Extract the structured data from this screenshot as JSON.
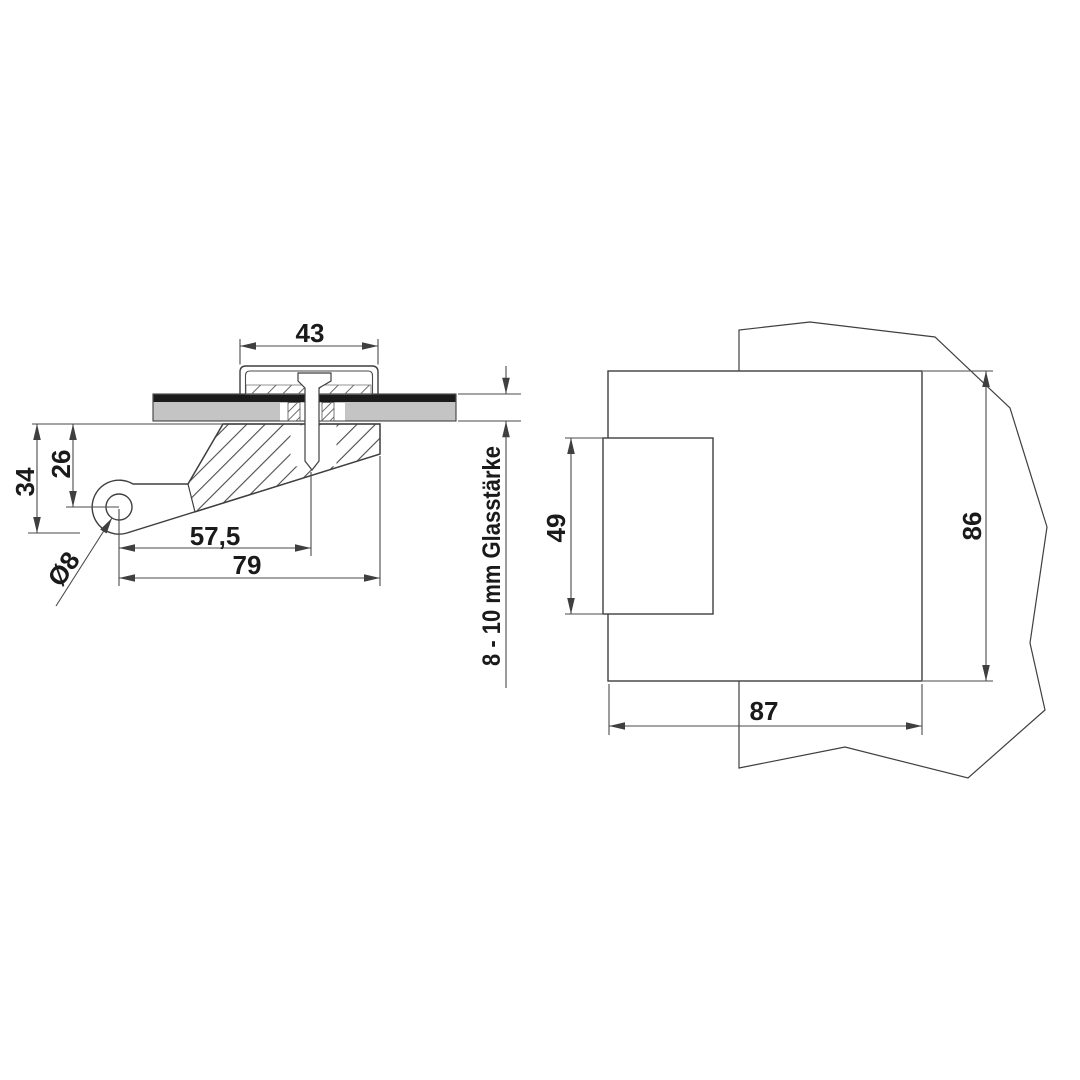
{
  "drawing": {
    "kind": "glass-clamp-fitting-technical-drawing",
    "views": {
      "side": {
        "dims": {
          "cap_width": "43",
          "pivot_to_glass": "26",
          "overall_depth": "34",
          "pivot_to_bolt": "57,5",
          "pivot_to_front_edge": "79",
          "pivot_hole_diameter": "Ø8",
          "glass_thickness_note": "8 - 10 mm Glasstärke"
        }
      },
      "top": {
        "dims": {
          "jaw_width": "49",
          "body_depth": "86",
          "body_width": "87"
        }
      }
    },
    "colors": {
      "line": "#3f3f3f",
      "dim_line": "#4a4a4a",
      "text": "#1a1a1a",
      "glass_fill": "#c4c4c4",
      "gasket_fill": "#1b1b1b"
    }
  }
}
